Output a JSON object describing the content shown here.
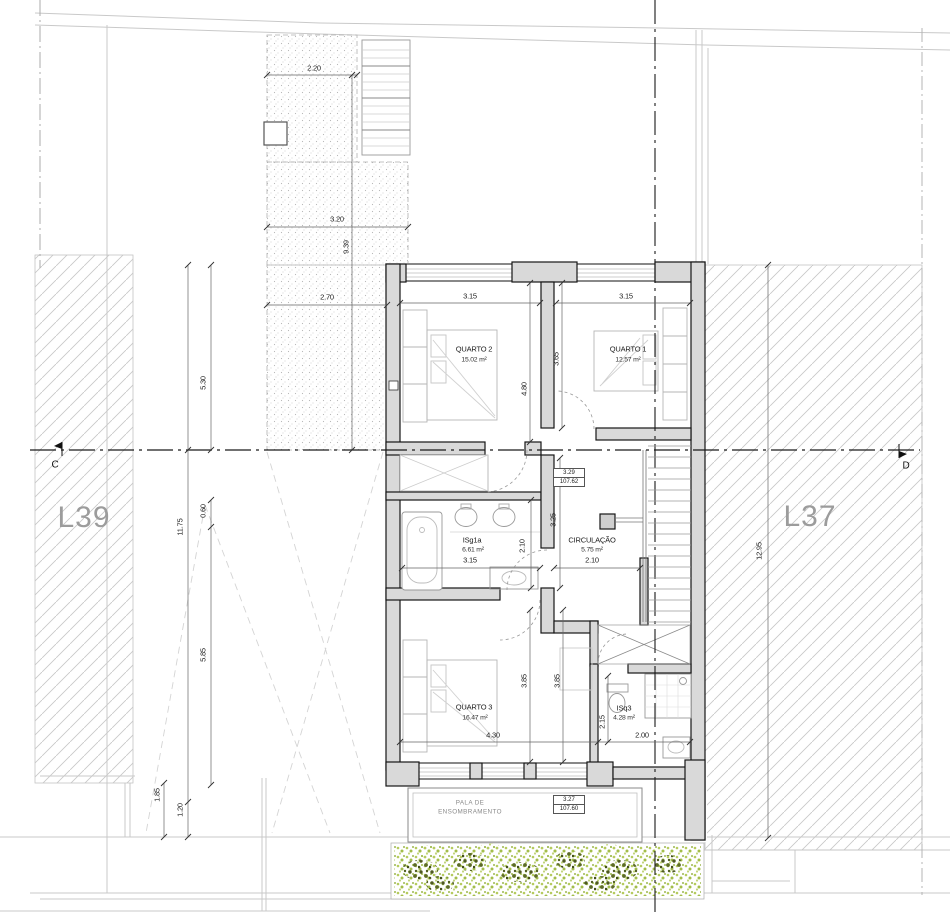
{
  "plan": {
    "lot_left": "L39",
    "lot_right": "L37",
    "section_left": "C",
    "section_right": "D",
    "rooms": {
      "quarto2": {
        "name": "QUARTO 2",
        "area": "15.02 m²"
      },
      "quarto1": {
        "name": "QUARTO 1",
        "area": "12.57 m²"
      },
      "isg1a": {
        "name": "ISg1a",
        "area": "6.61 m²"
      },
      "circulacao": {
        "name": "CIRCULAÇÃO",
        "area": "5.75 m²"
      },
      "quarto3": {
        "name": "QUARTO 3",
        "area": "16.47 m²"
      },
      "isq3": {
        "name": "ISq3",
        "area": "4.28 m²"
      }
    },
    "pala": {
      "line1": "PALA DE",
      "line2": "ENSOMBRAMENTO"
    },
    "levels": {
      "upper": {
        "value": "3.29",
        "elevation": "107.62"
      },
      "lower": {
        "value": "3.27",
        "elevation": "107.60"
      }
    },
    "dims": {
      "top_2_20": "2.20",
      "top_3_20": "3.20",
      "top_9_39": "9.39",
      "top_2_70": "2.70",
      "left_5_30": "5.30",
      "left_11_75": "11.75",
      "left_0_60": "0.60",
      "left_5_85": "5.85",
      "left_1_85": "1.85",
      "left_1_20": "1.20",
      "right_12_95": "12.95",
      "q2_width": "3.15",
      "q1_width": "3.15",
      "q2_depth": "4.80",
      "q1_depth": "3.65",
      "bath_width": "3.15",
      "bath_depth": "2.10",
      "corr_width": "2.10",
      "corr_depth": "3.25",
      "q3_depth_a": "3.85",
      "q3_depth_b": "3.85",
      "q3_width": "4.30",
      "isq3_depth": "2.15",
      "isq3_width": "2.00"
    }
  }
}
